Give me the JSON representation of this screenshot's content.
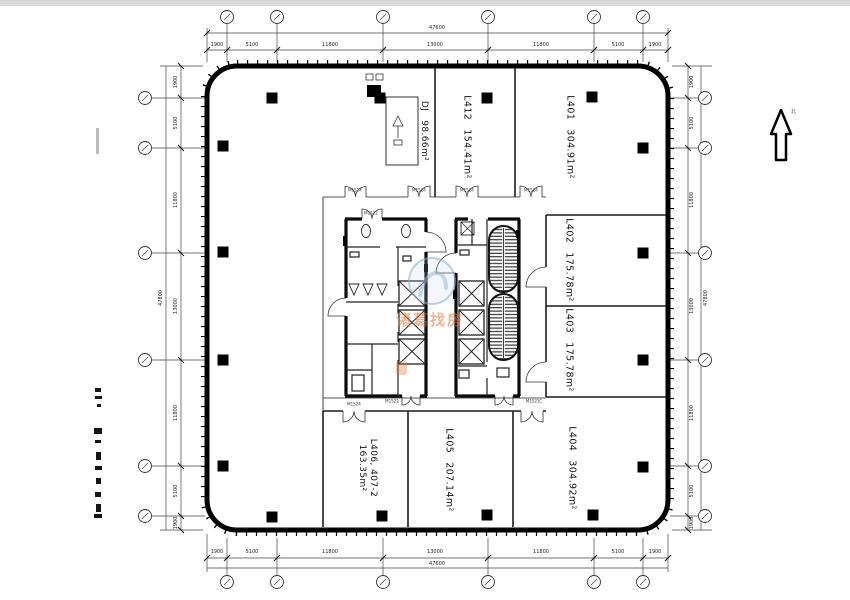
{
  "drawing": {
    "type": "architectural-floor-plan",
    "north_label": "北"
  },
  "rooms": [
    {
      "name": "DJ",
      "area": "98.66m²"
    },
    {
      "name": "L412",
      "area": "154.41m²"
    },
    {
      "name": "L401",
      "area": "304.91m²"
    },
    {
      "name": "L402",
      "area": "175.78m²"
    },
    {
      "name": "L403",
      "area": "175.78m²"
    },
    {
      "name": "L404",
      "area": "304.92m²"
    },
    {
      "name": "L405",
      "area": "207.14m²"
    },
    {
      "name": "L406",
      "name_line": "L406, 407-2",
      "area": "163.35m²"
    }
  ],
  "dimensions": {
    "horizontal": {
      "total": "47600",
      "segments": [
        "1900",
        "5100",
        "11800",
        "13000",
        "11800",
        "5100",
        "1900"
      ]
    },
    "vertical": {
      "total": "47800",
      "segments": [
        "1900",
        "5100",
        "11800",
        "13000",
        "11800",
        "5100",
        "1900"
      ]
    }
  },
  "door_tags": [
    {
      "label": "M1524"
    },
    {
      "label": "M1524"
    },
    {
      "label": "M1524"
    },
    {
      "label": "M1524"
    },
    {
      "label": "M1522"
    },
    {
      "label": "M1522"
    },
    {
      "label": "M1521C"
    },
    {
      "label": "M1524"
    }
  ],
  "watermark": {
    "text": "诸葛找房"
  }
}
